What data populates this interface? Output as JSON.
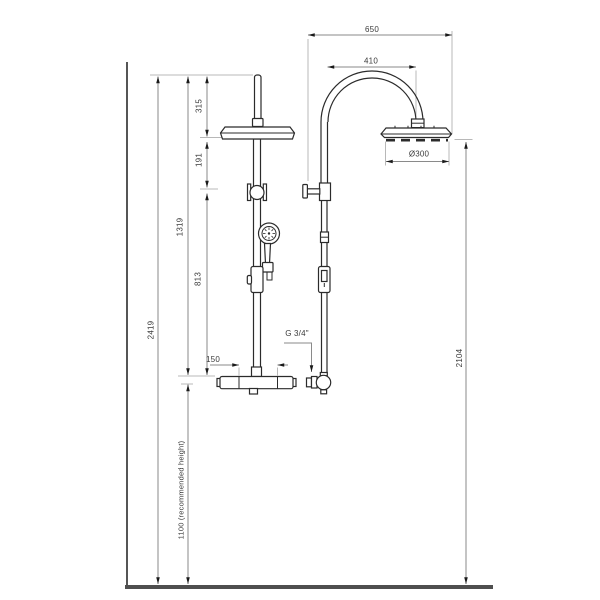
{
  "drawing": {
    "title": "shower-column-installation-drawing",
    "views": {
      "left": "front-view",
      "right": "side-view"
    },
    "colors": {
      "line": "#2b2b2b",
      "dimension_line": "#8a8a8a",
      "extension_line": "#b8b8b8",
      "floor": "#4f4f4f",
      "text": "#3a3a3a",
      "background": "#ffffff"
    },
    "dimensions": {
      "depth_overall": "650",
      "arm_projection": "410",
      "head_diameter": "Ø300",
      "top_to_head": "315",
      "head_to_diverter": "191",
      "top_to_mixer": "1319",
      "diverter_to_mixer": "813",
      "total_height": "2419",
      "inlet_spacing": "150",
      "mixer_height": "1100 (recommended height)",
      "head_floor_clearance": "2104",
      "thread": "G 3/4\""
    }
  }
}
